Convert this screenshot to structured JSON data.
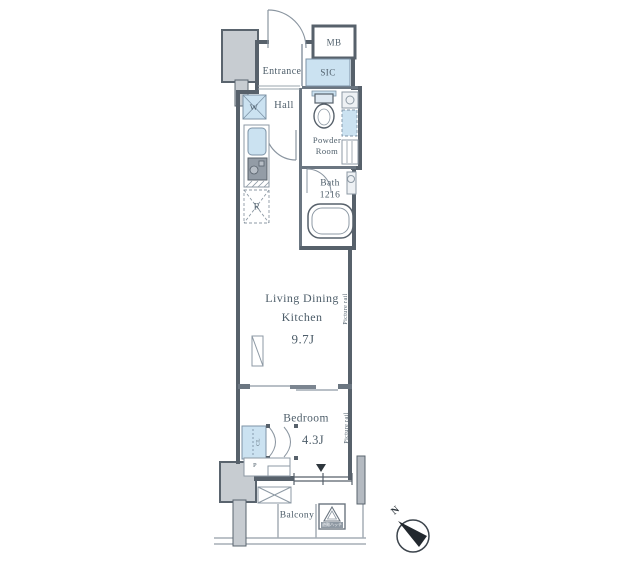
{
  "colors": {
    "wall": "#57616b",
    "thin_line": "#8d99a4",
    "fixture_blue": "#cbe2f1",
    "column_gray": "#c7ccd1",
    "text": "#4e5e6a",
    "background": "#ffffff"
  },
  "plan": {
    "mb": "MB",
    "entrance": "Entrance",
    "sic": "SIC",
    "hall": "Hall",
    "washer": "W",
    "powder_line1": "Powder",
    "powder_line2": "Room",
    "bath_line1": "Bath",
    "bath_line2": "1216",
    "ldk_line1": "Living Dining",
    "ldk_line2": "Kitchen",
    "ldk_size": "9.7J",
    "bedroom": "Bedroom",
    "bedroom_size": "4.3J",
    "closet": "CL",
    "fridge": "R",
    "pipe": "P",
    "picture_rail": "Picture rail",
    "balcony": "Balcony",
    "evac_hatch": "避難ハッチ",
    "north": "N"
  }
}
